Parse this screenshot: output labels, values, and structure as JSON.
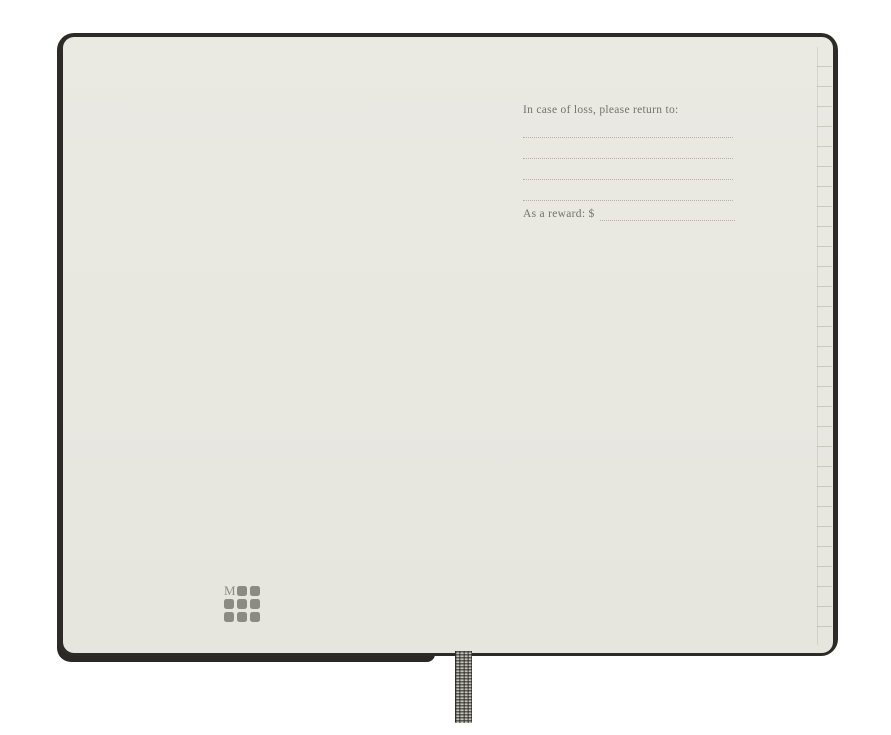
{
  "notebook": {
    "return_prompt": "In case of loss, please return to:",
    "reward_prompt": "As a reward: $",
    "writing_line_count": 4,
    "logo": {
      "letter": "M",
      "rows": 3,
      "cols": 3
    },
    "colors": {
      "backdrop": "#ffffff",
      "cover": "#2c2b27",
      "page": "#e8e7e0",
      "ink": "#73726b",
      "rule_line": "#b5b2a3",
      "logo_gray": "#8b8a83",
      "ribbon": "#8e8c84"
    }
  }
}
